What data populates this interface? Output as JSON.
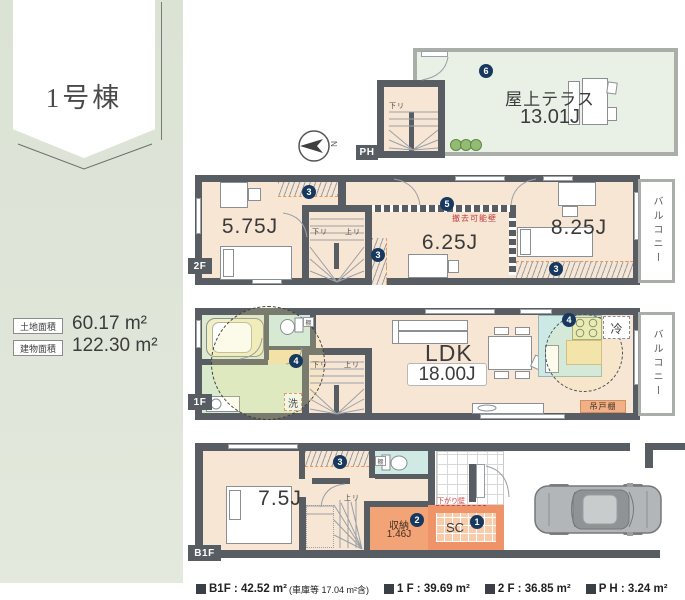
{
  "banner": {
    "title": "1号棟"
  },
  "site": {
    "rows": [
      {
        "label": "土地面積",
        "value": "60.17 m²"
      },
      {
        "label": "建物面積",
        "value": "122.30 m²"
      }
    ]
  },
  "compass": {
    "label": "N"
  },
  "floors": {
    "ph": {
      "tag": "PH",
      "room": "屋上テラス",
      "size": "13.01J",
      "stair_down": "下リ",
      "marker": "6"
    },
    "f2": {
      "tag": "2F",
      "room_a": "5.75J",
      "room_b": "6.25J",
      "room_c": "8.25J",
      "balcony": "バルコニー",
      "removable": "撤去可能壁",
      "stair_down": "下リ",
      "stair_up": "上リ",
      "marker_closet": "3",
      "marker_side": "3",
      "marker_c_closet": "3",
      "marker_wall": "5"
    },
    "f1": {
      "tag": "1F",
      "ldk": "LDK",
      "ldk_size": "18.00J",
      "balcony": "バルコニー",
      "fridge": "冷",
      "cupboard": "吊戸棚",
      "washer": "洗",
      "shelf": "棚",
      "stair_down": "下リ",
      "stair_up": "上リ",
      "marker_bath": "4",
      "marker_kitchen": "4"
    },
    "b1f": {
      "tag": "B1F",
      "room": "7.5J",
      "storage": "収納",
      "storage_size": "1.46J",
      "shoe_closet": "SC",
      "shelf": "棚",
      "stair_up": "上リ",
      "dropped_wall": "下がり壁",
      "marker_sc": "1",
      "marker_storage": "2",
      "marker_closet": "3"
    }
  },
  "footer": {
    "items": [
      {
        "text": "B1F : 42.52 m²",
        "note": "(車庫等 17.04 m²含)"
      },
      {
        "text": "1 F : 39.69 m²",
        "note": ""
      },
      {
        "text": "2 F : 36.85 m²",
        "note": ""
      },
      {
        "text": "P H : 3.24 m²",
        "note": ""
      }
    ]
  },
  "colors": {
    "wall": "#585d63",
    "floor": "#f8e6d5",
    "terrace": "#e9f1e7",
    "sidebar": "#dee5d8",
    "marker_navy": "#17395f",
    "wet_teal": "#cfe9e4",
    "bath_green": "#dcead0",
    "storage_orange": "#f2a476",
    "note_red": "#c94040"
  }
}
